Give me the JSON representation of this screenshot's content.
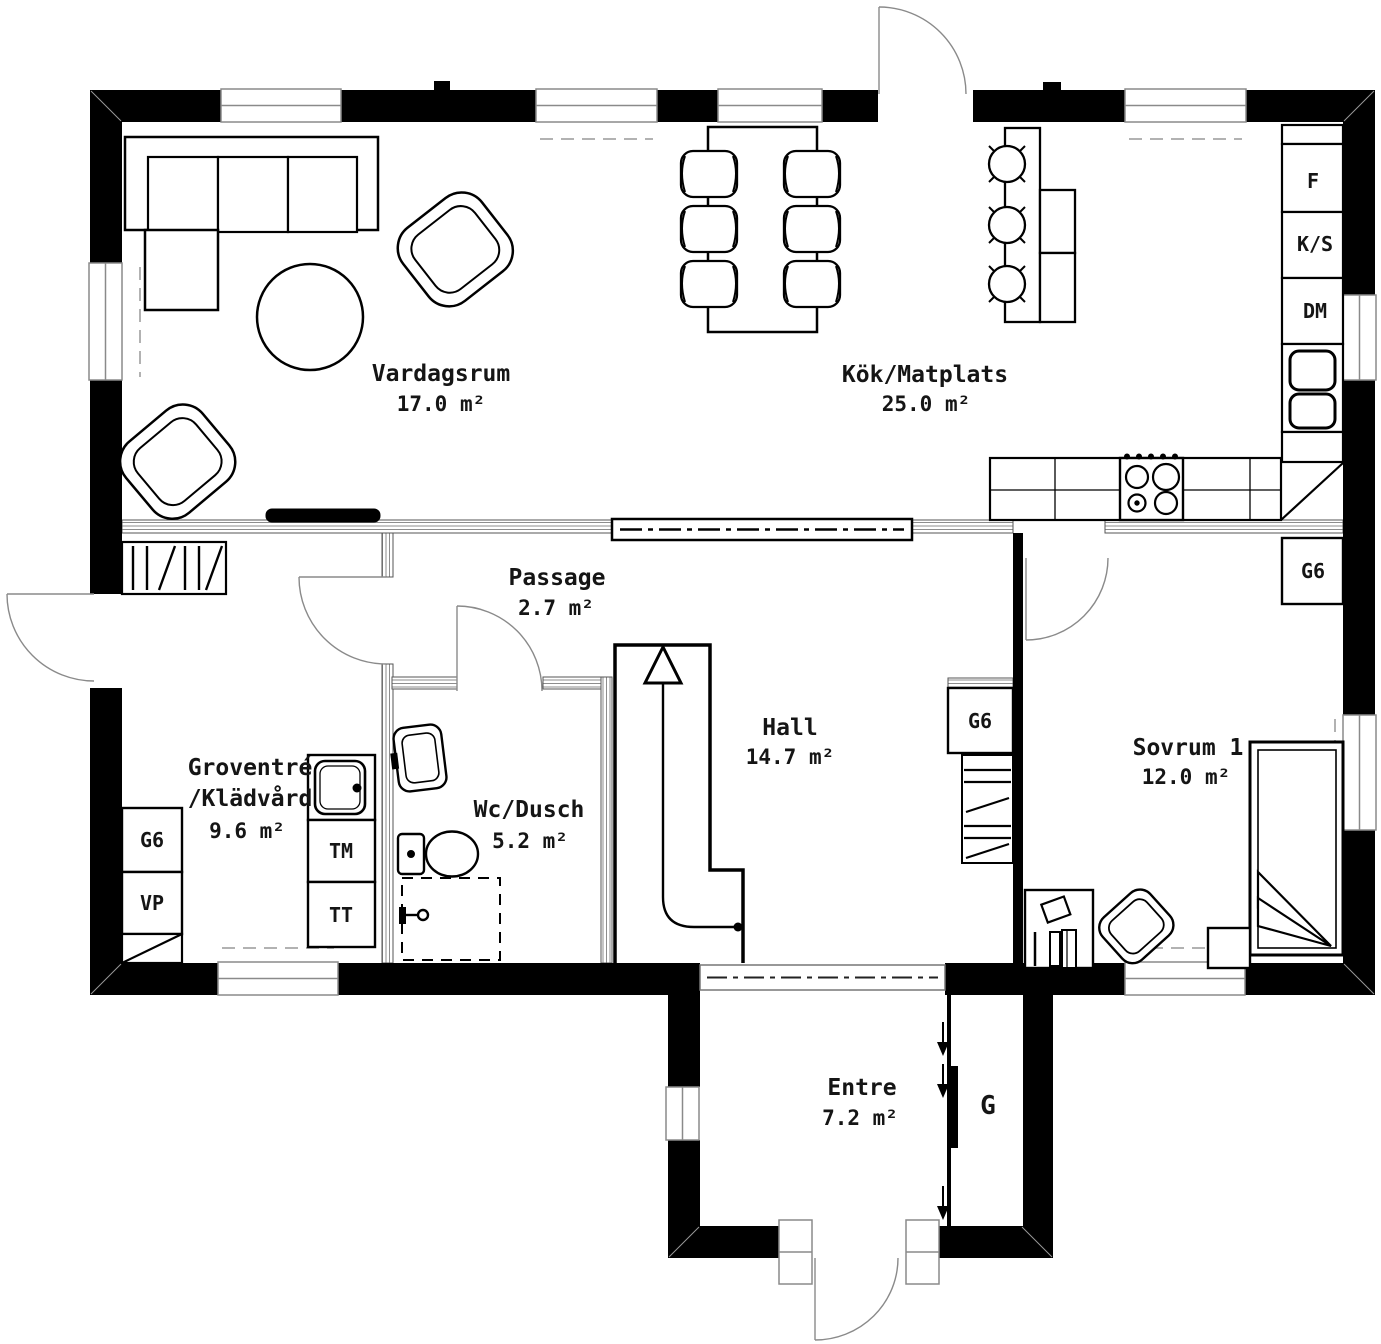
{
  "rooms": {
    "vardagsrum": {
      "name": "Vardagsrum",
      "area": "17.0 m²"
    },
    "kok": {
      "name": "Kök/Matplats",
      "area": "25.0 m²"
    },
    "passage": {
      "name": "Passage",
      "area": "2.7 m²"
    },
    "groventre": {
      "name_line1": "Groventré",
      "name_line2": "/Klädvård",
      "area": "9.6 m²"
    },
    "wc_dusch": {
      "name": "Wc/Dusch",
      "area": "5.2 m²"
    },
    "hall": {
      "name": "Hall",
      "area": "14.7 m²"
    },
    "sovrum1": {
      "name": "Sovrum 1",
      "area": "12.0 m²"
    },
    "entre": {
      "name": "Entre",
      "area": "7.2 m²"
    }
  },
  "codes": {
    "fridge": "F",
    "freezer": "K/S",
    "dishwasher": "DM",
    "wardrobe": "G6",
    "heat_pump": "VP",
    "washing_machine": "TM",
    "tumble_dryer": "TT",
    "closet": "G"
  },
  "colors": {
    "wall": "#000000",
    "background": "#ffffff",
    "light_line": "#8a8a8a"
  }
}
